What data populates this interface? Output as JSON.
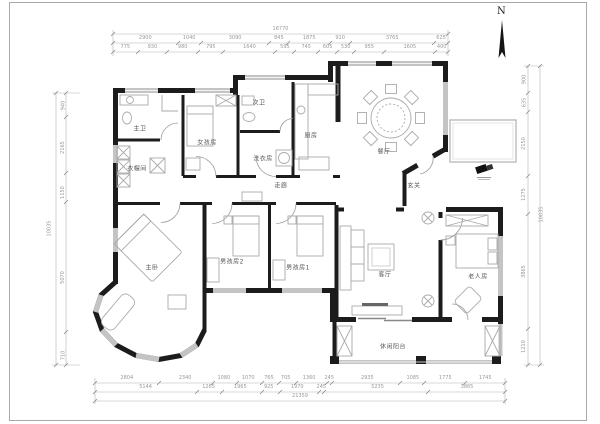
{
  "compass": {
    "north": "N"
  },
  "rooms": {
    "master_bath": {
      "label": "主卫"
    },
    "cloakroom": {
      "label": "衣帽间"
    },
    "girls_room": {
      "label": "女孩房"
    },
    "second_bath": {
      "label": "次卫"
    },
    "laundry": {
      "label": "洗衣房"
    },
    "kitchen": {
      "label": "厨房"
    },
    "dining": {
      "label": "餐厅"
    },
    "foyer": {
      "label": "玄关"
    },
    "corridor": {
      "label": "走廊"
    },
    "master_bedroom": {
      "label": "主卧"
    },
    "boys_room_2": {
      "label": "男孩房2"
    },
    "boys_room_1": {
      "label": "男孩房1"
    },
    "living": {
      "label": "客厅"
    },
    "elders_room": {
      "label": "老人房"
    },
    "balcony": {
      "label": "休闲阳台"
    }
  },
  "dims": {
    "top_total": "16770",
    "top_b": [
      "2900",
      "1040",
      "3090",
      "845",
      "1875",
      "910",
      "3765",
      "625"
    ],
    "top_c": [
      "775",
      "930",
      "980",
      "795",
      "1640",
      "595",
      "745",
      "605",
      "530",
      "955",
      "1605",
      "400"
    ],
    "bottom_1": [
      "2804",
      "2340",
      "1080",
      "1070",
      "765",
      "705",
      "1360",
      "245",
      "2935",
      "1085",
      "1775",
      "1745"
    ],
    "bottom_2": [
      "5144",
      "1265",
      "1965",
      "925",
      "1970",
      "245",
      "5235",
      "3865"
    ],
    "bottom_total": "21359",
    "left": [
      "940",
      "2165",
      "1150",
      "5070",
      "710"
    ],
    "left_total": "10035",
    "right": [
      "900",
      "635",
      "2150",
      "1275",
      "3865",
      "1210"
    ],
    "right_total": "10035"
  },
  "colors": {
    "wall": "#1c1c1c",
    "window": "#c4c4c4",
    "furniture": "#aaaaaa",
    "dim": "#9a9a9a",
    "label": "#555555"
  }
}
